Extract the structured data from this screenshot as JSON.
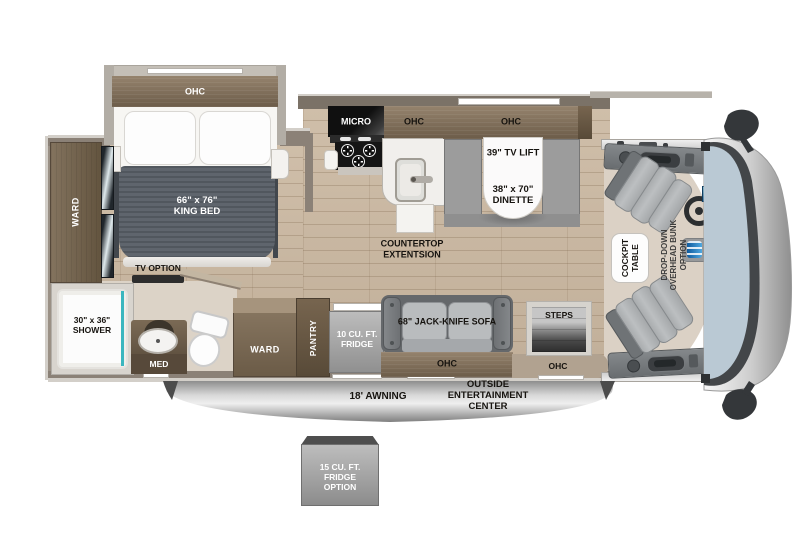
{
  "bedroom": {
    "ohc": "OHC",
    "bed_size": "66\" x 76\"",
    "bed_name": "KING BED",
    "ward": "WARD",
    "tv_option": "TV OPTION"
  },
  "bath": {
    "shower_size": "30\" x 36\"",
    "shower_name": "SHOWER",
    "med": "MED"
  },
  "hall": {
    "ward": "WARD",
    "pantry": "PANTRY",
    "fridge_size": "10 CU. FT.",
    "fridge_name": "FRIDGE"
  },
  "kitchen": {
    "micro": "MICRO",
    "ohc": "OHC",
    "countertop_line1": "COUNTERTOP",
    "countertop_line2": "EXTENTSION"
  },
  "dinette": {
    "ohc": "OHC",
    "tv_lift": "39\" TV LIFT",
    "size": "38\" x 70\"",
    "name": "DINETTE"
  },
  "living": {
    "sofa": "68\" JACK-KNIFE SOFA",
    "sofa_ohc": "OHC",
    "steps": "STEPS",
    "entry_ohc": "OHC"
  },
  "cockpit": {
    "table_line1": "COCKPIT",
    "table_line2": "TABLE",
    "bunk_line1": "DROP-DOWN",
    "bunk_line2": "OVERHEAD BUNK",
    "bunk_line3": "OPTION"
  },
  "exterior": {
    "awning": "18' AWNING",
    "oec_line1": "OUTSIDE",
    "oec_line2": "ENTERTAINMENT",
    "oec_line3": "CENTER",
    "fridge_option_line1": "15 CU. FT.",
    "fridge_option_line2": "FRIDGE",
    "fridge_option_line3": "OPTION"
  },
  "colors": {
    "wood": "#7c6b57",
    "floor": "#c9b8a3",
    "mattress": "#565c63",
    "teal_accent": "#3ab6bf",
    "windshield": "#b9c8d3",
    "awning_gray": "#9a9a9a"
  }
}
